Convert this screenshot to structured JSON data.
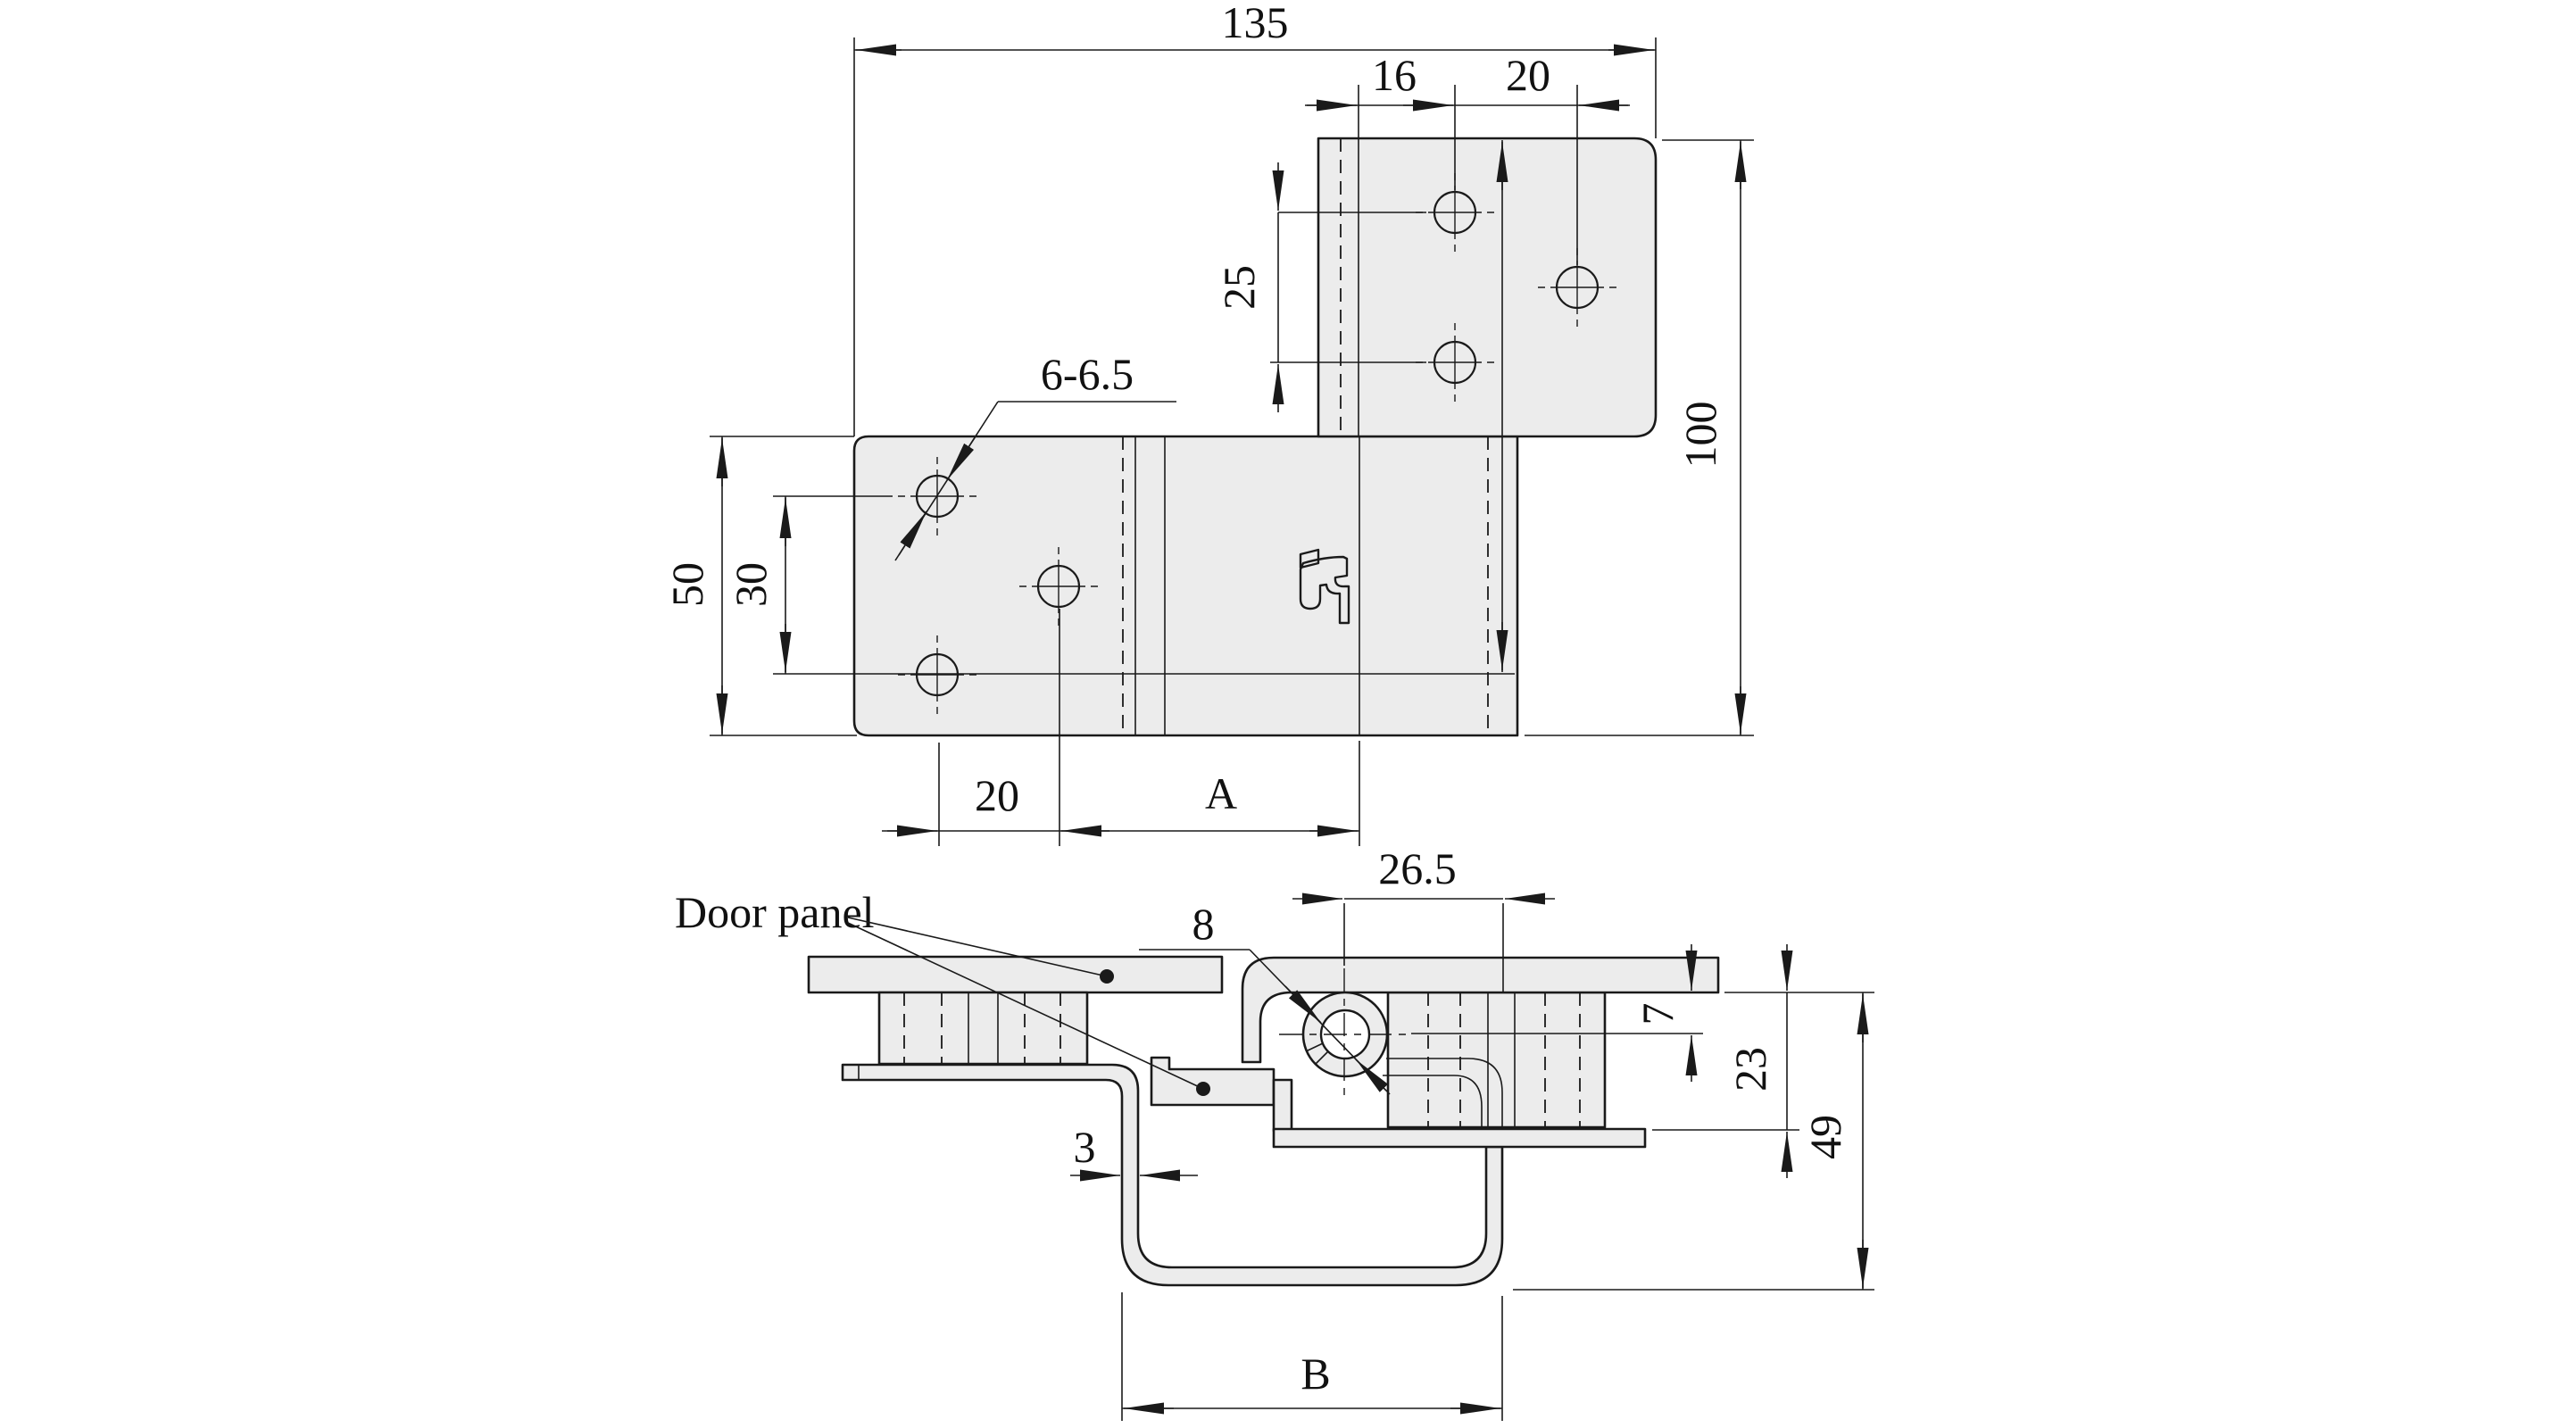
{
  "drawing": {
    "kind": "hinge-technical-drawing",
    "background": "#ffffff",
    "line_color": "#1a1a1a",
    "part_fill": "#ececec"
  },
  "plan_view": {
    "dims": {
      "total_width": "135",
      "hole_inset": "16",
      "hole_pitch_h": "20",
      "hole_pitch_v": "25",
      "total_height": "100",
      "hole_diameter": "6-6.5",
      "leaf_height": "50",
      "hole_span": "30",
      "hole_edge_offset": "20",
      "center_distance": "A"
    }
  },
  "section_view": {
    "labels": {
      "door_panel": "Door panel"
    },
    "dims": {
      "pivot_to_leaf_edge": "26.5",
      "pin_diameter": "8",
      "surface_to_pivot": "7",
      "panel_drop": "23",
      "overall_depth": "49",
      "sheet_thickness": "3",
      "channel_width": "B"
    }
  }
}
